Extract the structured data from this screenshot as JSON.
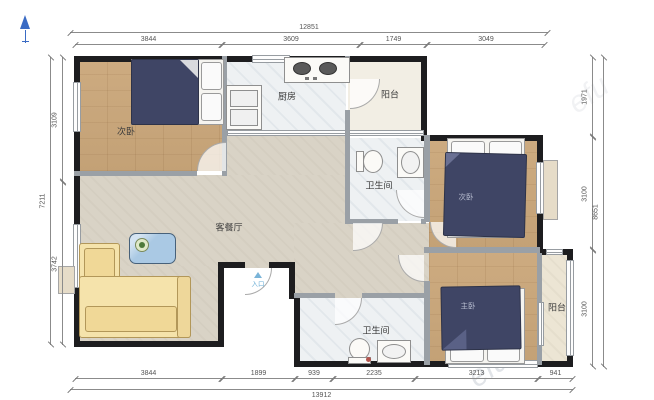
{
  "rooms": {
    "bedroom_a": "次卧",
    "kitchen": "厨房",
    "balcony_top": "阳台",
    "bathroom_top": "卫生间",
    "living": "客餐厅",
    "bedroom_b": "次卧",
    "bedroom_master": "主卧",
    "bathroom_bottom": "卫生间",
    "balcony_bottom": "阳台",
    "entrance": "入口"
  },
  "dimensions": {
    "top": {
      "total": "12851",
      "segments": [
        "3844",
        "3609",
        "1749",
        "3049"
      ]
    },
    "bottom": {
      "total": "13912",
      "segments": [
        "3844",
        "1899",
        "939",
        "2235",
        "3213",
        "941"
      ]
    },
    "left": {
      "total": "7211",
      "segments": [
        "3109",
        "3742"
      ]
    },
    "right": {
      "total": "8651",
      "segments": [
        "1971",
        "3100",
        "3100"
      ]
    }
  },
  "watermark": "efu",
  "colors": {
    "outer_wall": "#1d1d1f",
    "inner_wall": "#9aa0a6",
    "wood_floor": "#c9a87e",
    "living_floor": "#d9d3c6",
    "bed": "#3f4565",
    "sofa": "#f5e3ab",
    "entrance_text": "#6aaed6",
    "compass": "#3a6bc4"
  }
}
